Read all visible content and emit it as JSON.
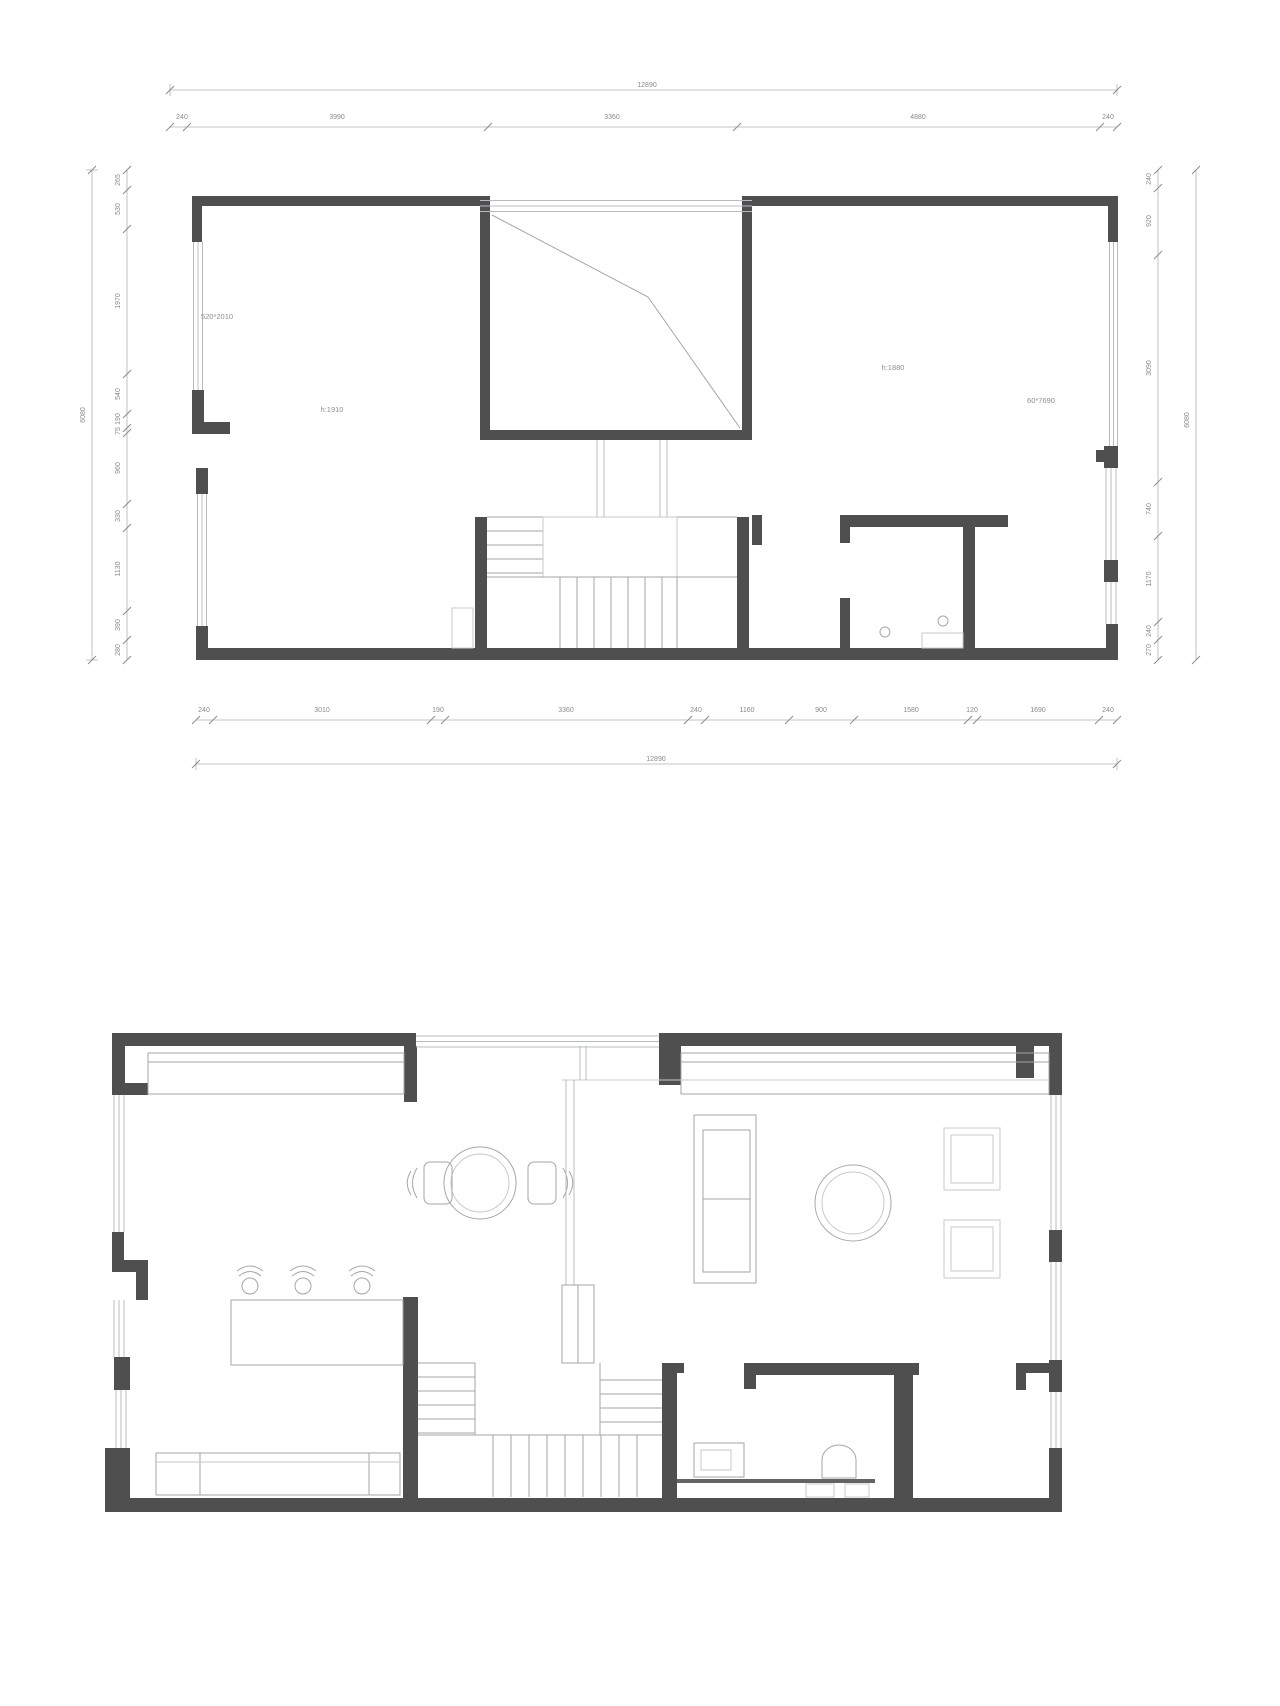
{
  "colors": {
    "wall": "#4f4f4f",
    "thin_line": "#a6a6a6",
    "window_line": "#b8bcc0",
    "dimension_line": "#b3b3b3",
    "dimension_text": "#8a8a8a",
    "background": "#ffffff"
  },
  "plan_upper": {
    "name": "upper-floor-plan",
    "labels": {
      "window_size": "520*2010",
      "height_left": "h:1910",
      "height_right": "h:1880",
      "railing_size": "60*7690"
    },
    "dims": {
      "top_overall": "12890",
      "top_segments": [
        "240",
        "3990",
        "3360",
        "4880",
        "240"
      ],
      "bottom_segments": [
        "240",
        "3010",
        "190",
        "3360",
        "240",
        "1160",
        "900",
        "1580",
        "120",
        "1690",
        "240"
      ],
      "bottom_overall": "12890",
      "left_overall": "6080",
      "left_segments": [
        "265",
        "530",
        "1970",
        "540",
        "190",
        "75",
        "960",
        "330",
        "1130",
        "390",
        "280"
      ],
      "right_segments": [
        "240",
        "920",
        "3090",
        "740",
        "1170",
        "240",
        "270"
      ],
      "right_overall": "6080"
    }
  },
  "plan_lower": {
    "name": "ground-floor-plan"
  }
}
